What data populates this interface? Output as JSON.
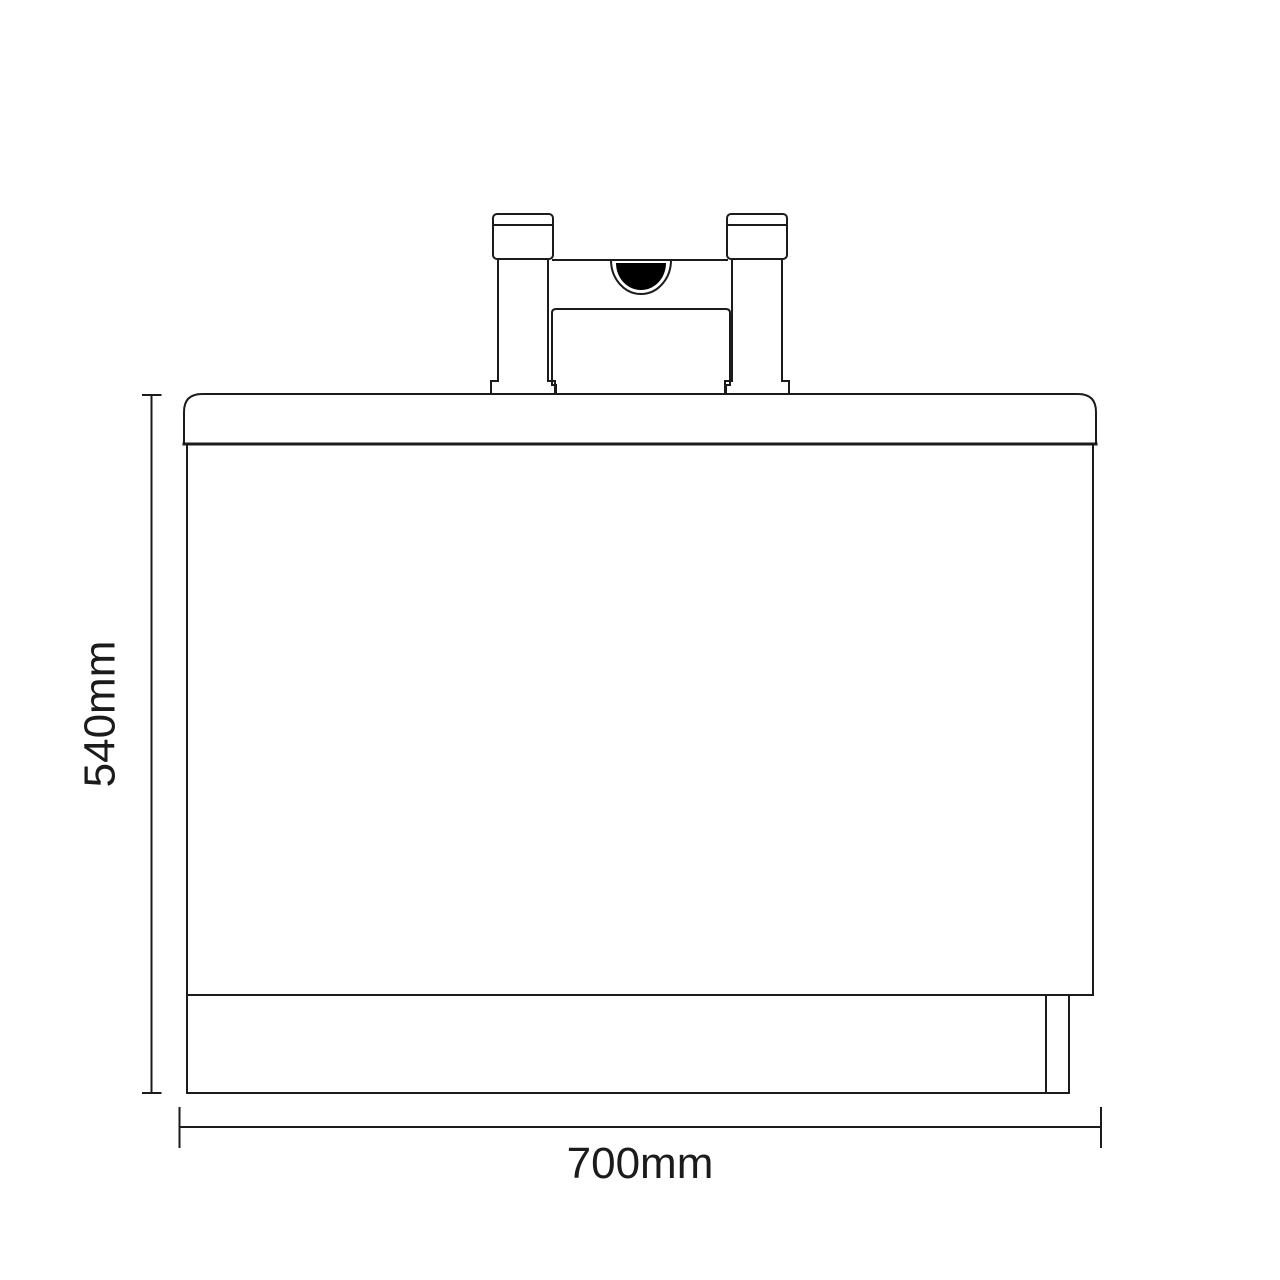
{
  "drawing": {
    "type": "technical line drawing",
    "subject": "Bath front panel elevation with deck-mounted bath filler tap",
    "dimension_labels": {
      "height": "540mm",
      "width": "700mm"
    },
    "colors": {
      "line": "#1b1b1b",
      "background": "#ffffff",
      "spout_fill": "#000000"
    }
  }
}
